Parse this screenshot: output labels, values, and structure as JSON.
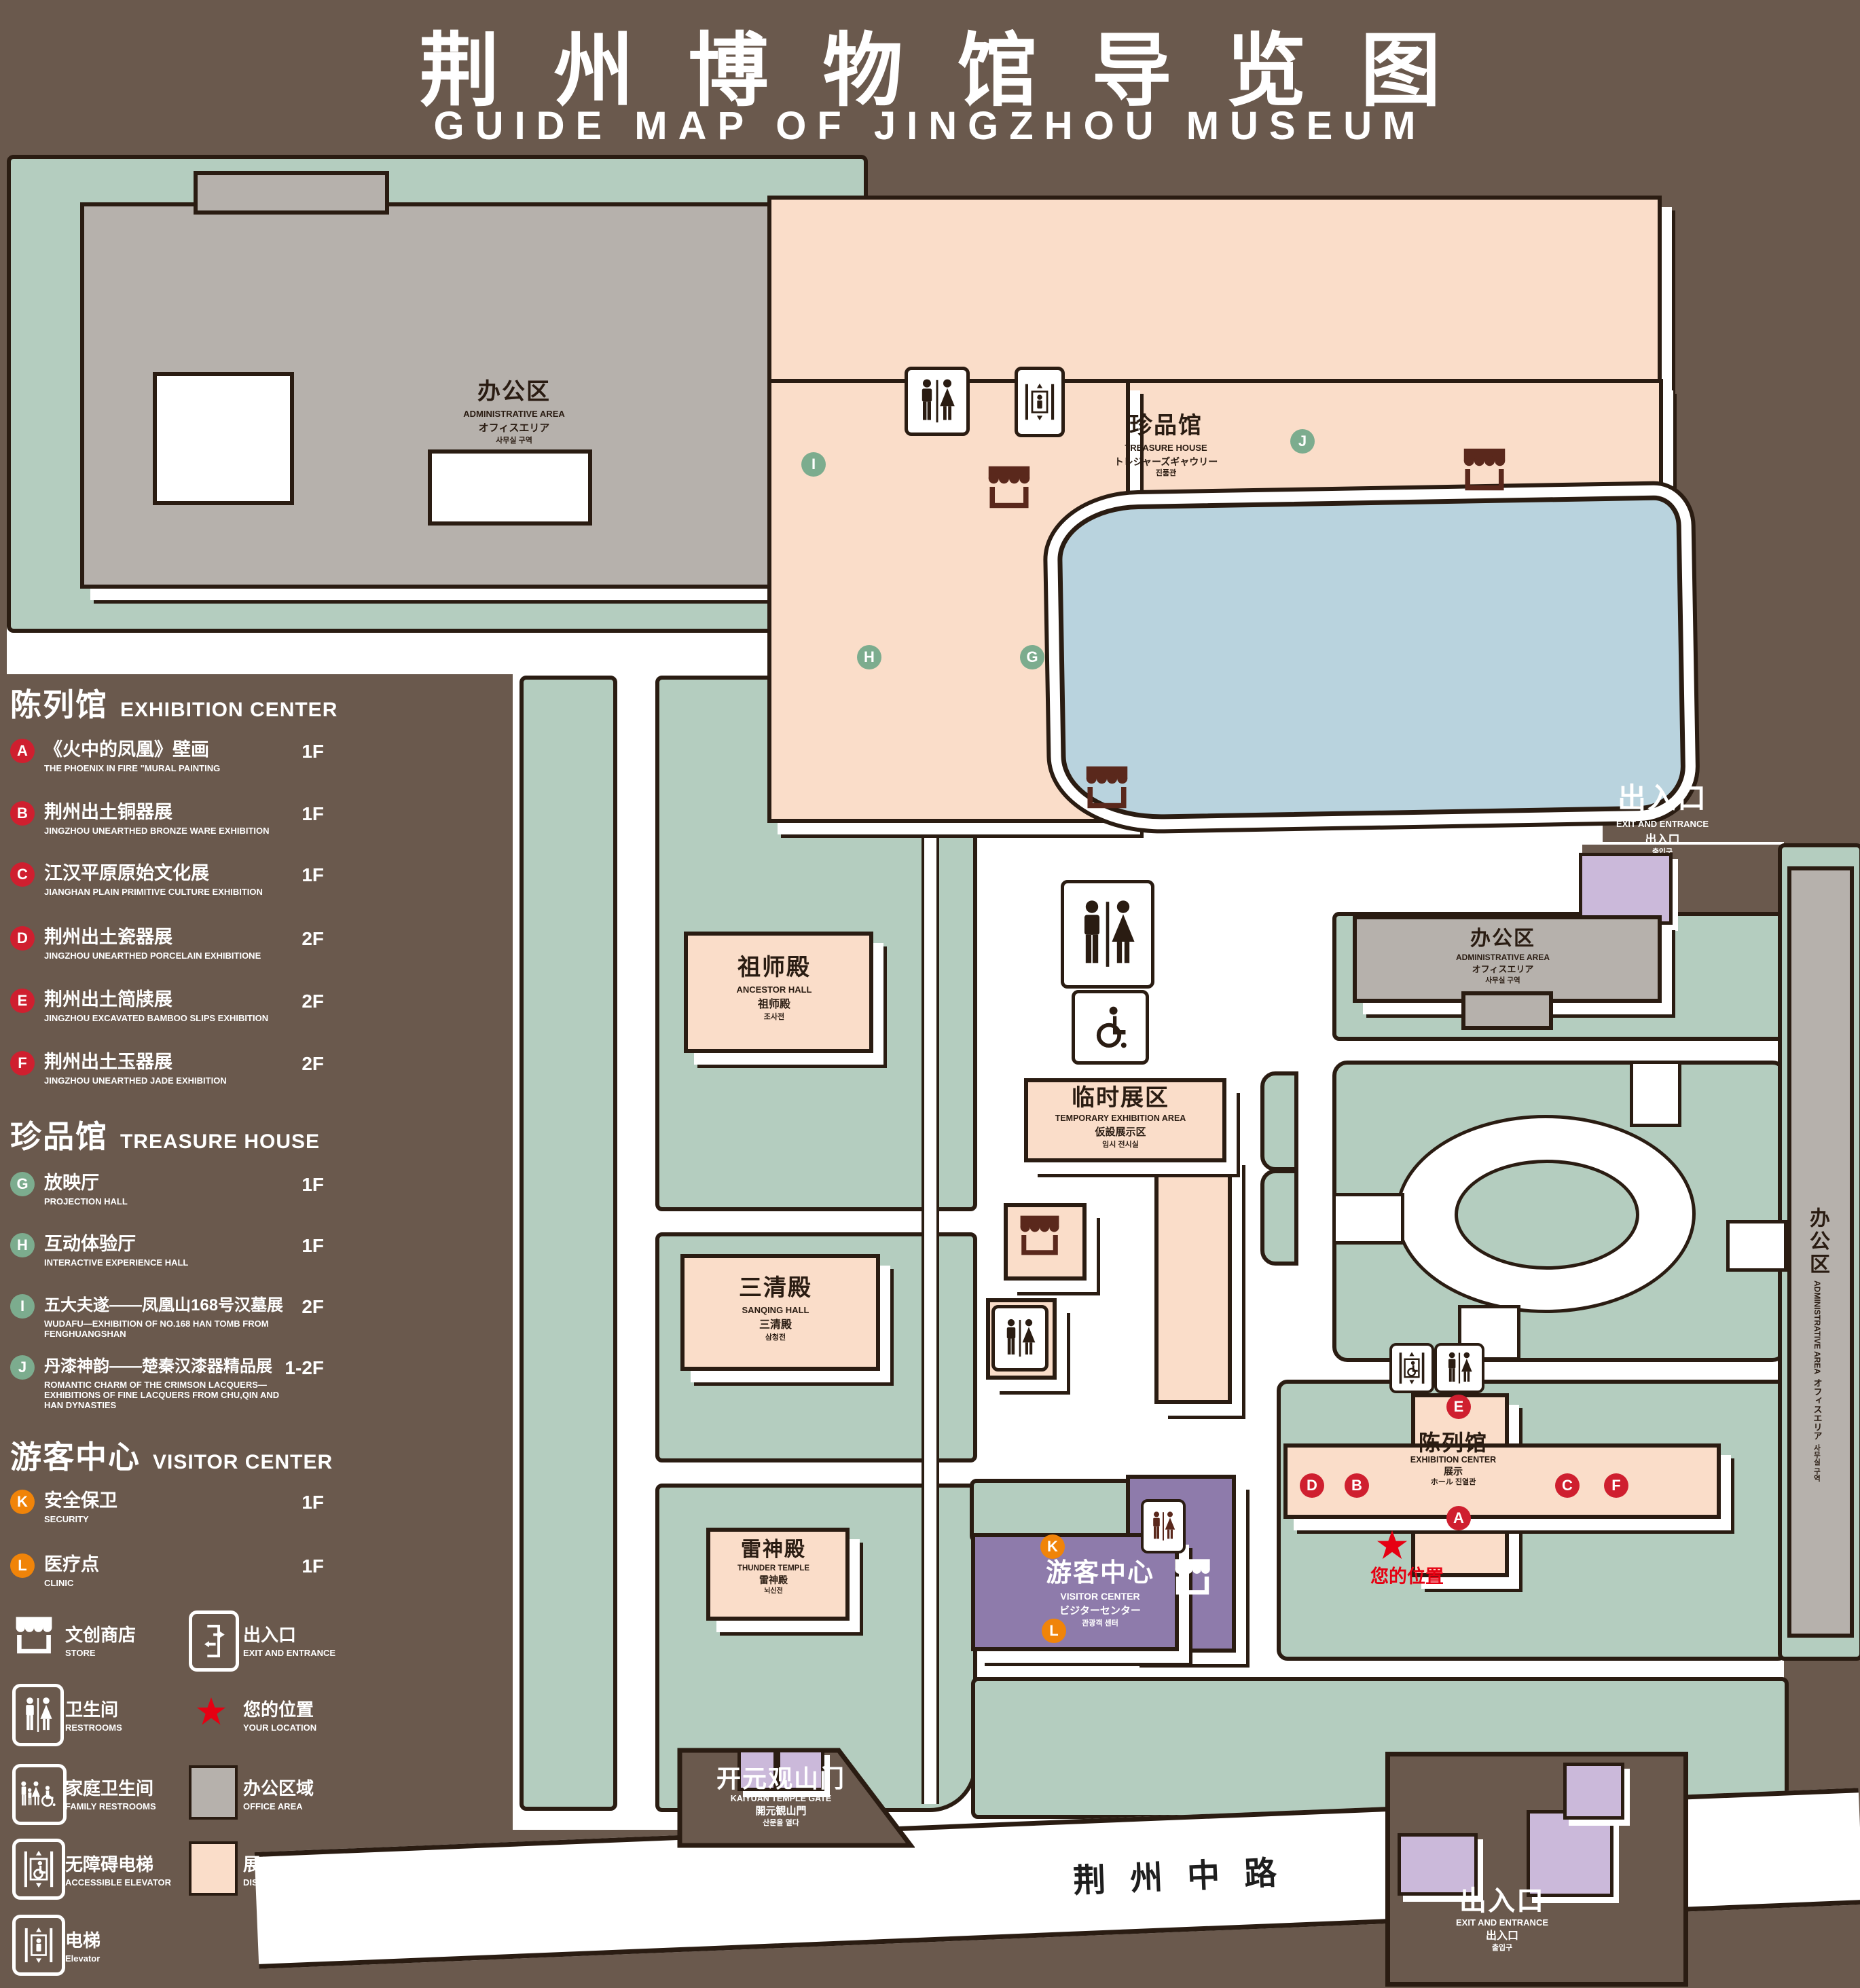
{
  "title": {
    "zh": "荆州博物馆导览图",
    "en": "GUIDE MAP OF JINGZHOU MUSEUM"
  },
  "colors": {
    "background": "#6A594D",
    "map_green": "#B4CDBF",
    "display_area_pink": "#FADDC9",
    "office_area_gray": "#B6B1AC",
    "visitor_purple": "#8E7BAB",
    "lavender_building": "#CBB9DA",
    "pond_blue": "#B9D3DE",
    "badge_red": "#CF1F2F",
    "badge_green": "#7CAC8E",
    "badge_orange": "#F08409",
    "location_red": "#E60012",
    "outline": "#2A1C12"
  },
  "legend": {
    "sections": [
      {
        "zh": "陈列馆",
        "en": "EXHIBITION CENTER"
      },
      {
        "zh": "珍品馆",
        "en": "TREASURE HOUSE"
      },
      {
        "zh": "游客中心",
        "en": "VISITOR CENTER"
      }
    ],
    "items": [
      {
        "letter": "A",
        "zh": "《火中的凤凰》壁画",
        "en": "THE PHOENIX IN FIRE \"MURAL PAINTING",
        "floor": "1F"
      },
      {
        "letter": "B",
        "zh": "荆州出土铜器展",
        "en": "JINGZHOU UNEARTHED BRONZE WARE EXHIBITION",
        "floor": "1F"
      },
      {
        "letter": "C",
        "zh": "江汉平原原始文化展",
        "en": "JIANGHAN PLAIN PRIMITIVE CULTURE EXHIBITION",
        "floor": "1F"
      },
      {
        "letter": "D",
        "zh": "荆州出土瓷器展",
        "en": "JINGZHOU UNEARTHED PORCELAIN EXHIBITIONE",
        "floor": "2F"
      },
      {
        "letter": "E",
        "zh": "荆州出土简牍展",
        "en": "JINGZHOU EXCAVATED BAMBOO SLIPS EXHIBITION",
        "floor": "2F"
      },
      {
        "letter": "F",
        "zh": "荆州出土玉器展",
        "en": "JINGZHOU UNEARTHED JADE EXHIBITION",
        "floor": "2F"
      },
      {
        "letter": "G",
        "zh": "放映厅",
        "en": "PROJECTION HALL",
        "floor": "1F"
      },
      {
        "letter": "H",
        "zh": "互动体验厅",
        "en": "INTERACTIVE EXPERIENCE HALL",
        "floor": "1F"
      },
      {
        "letter": "I",
        "zh": "五大夫遂——凤凰山168号汉墓展",
        "en": "WUDAFU—EXHIBITION OF NO.168 HAN TOMB FROM FENGHUANGSHAN",
        "floor": "2F"
      },
      {
        "letter": "J",
        "zh": "丹漆神韵——楚秦汉漆器精品展",
        "en": "ROMANTIC CHARM OF THE CRIMSON LACQUERS—EXHIBITIONS OF FINE LACQUERS FROM CHU,QIN AND HAN DYNASTIES",
        "floor": "1-2F"
      },
      {
        "letter": "K",
        "zh": "安全保卫",
        "en": "SECURITY",
        "floor": "1F"
      },
      {
        "letter": "L",
        "zh": "医疗点",
        "en": "CLINIC",
        "floor": "1F"
      }
    ],
    "symbols": [
      {
        "zh": "文创商店",
        "en": "STORE"
      },
      {
        "zh": "出入口",
        "en": "EXIT AND ENTRANCE"
      },
      {
        "zh": "卫生间",
        "en": "RESTROOMS"
      },
      {
        "zh": "您的位置",
        "en": "YOUR LOCATION"
      },
      {
        "zh": "家庭卫生间",
        "en": "FAMILY RESTROOMS"
      },
      {
        "zh": "办公区域",
        "en": "OFFICE AREA"
      },
      {
        "zh": "无障碍电梯",
        "en": "ACCESSIBLE ELEVATOR"
      },
      {
        "zh": "展示区域",
        "en": "DISPLAY AREA"
      },
      {
        "zh": "电梯",
        "en": "Elevator"
      }
    ]
  },
  "map": {
    "admin_nw": {
      "zh": "办公区",
      "en": "ADMINISTRATIVE AREA",
      "ja": "オフィスエリア",
      "ko": "사무실 구역"
    },
    "treasure": {
      "zh": "珍品馆",
      "en": "TREASURE HOUSE",
      "ja": "トレジャーズギャウリー",
      "ko": "진품관"
    },
    "ancestor": {
      "zh": "祖师殿",
      "en": "ANCESTOR HALL",
      "ja": "祖师殿",
      "ko": "조사전"
    },
    "temporary": {
      "zh": "临时展区",
      "en": "TEMPORARY EXHIBITION AREA",
      "ja": "仮設展示区",
      "ko": "임시 전시실"
    },
    "admin_e": {
      "zh": "办公区",
      "en": "ADMINISTRATIVE AREA",
      "ja": "オフィスエリア",
      "ko": "사무실 구역"
    },
    "sanqing": {
      "zh": "三清殿",
      "en": "SANQING HALL",
      "ja": "三清殿",
      "ko": "삼청전"
    },
    "thunder": {
      "zh": "雷神殿",
      "en": "THUNDER TEMPLE",
      "ja": "雷神殿",
      "ko": "뇌신전"
    },
    "visitor": {
      "zh": "游客中心",
      "en": "VISITOR CENTER",
      "ja": "ビジターセンター",
      "ko": "관광객 센터"
    },
    "exhibition": {
      "zh": "陈列馆",
      "en": "EXHIBITION CENTER",
      "ja": "展示",
      "ko": "ホール 진열관"
    },
    "exit": {
      "zh": "出入口",
      "en": "EXIT AND ENTRANCE",
      "zh2": "出入口",
      "ko": "출입구"
    },
    "gate": {
      "zh": "开元观山门",
      "en": "KAIYUAN TEMPLE GATE",
      "ja": "開元観山門",
      "ko": "산문을 열다"
    },
    "road": "荆州中路",
    "your_location": "您的位置",
    "badges": {
      "A": "A",
      "B": "B",
      "C": "C",
      "D": "D",
      "E": "E",
      "F": "F",
      "G": "G",
      "H": "H",
      "I": "I",
      "J": "J",
      "K": "K",
      "L": "L"
    }
  }
}
